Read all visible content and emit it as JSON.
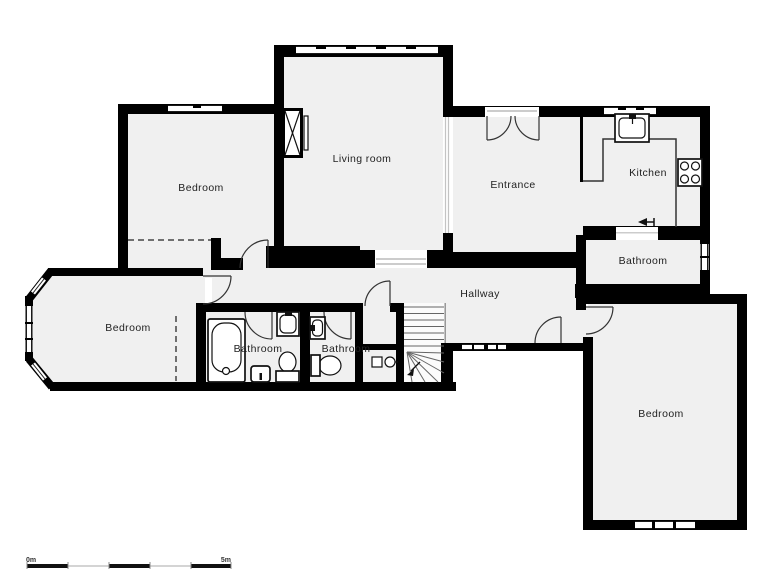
{
  "colors": {
    "wall": "#000000",
    "floor": "#f0f0f0",
    "background": "#ffffff",
    "door_arc": "#333333",
    "fixture_stroke": "#111111",
    "label_text": "#222222"
  },
  "rooms": [
    {
      "id": "bedroom-top-left",
      "label": "Bedroom"
    },
    {
      "id": "living-room",
      "label": "Living room"
    },
    {
      "id": "entrance",
      "label": "Entrance"
    },
    {
      "id": "kitchen",
      "label": "Kitchen"
    },
    {
      "id": "bathroom-top-right",
      "label": "Bathroom"
    },
    {
      "id": "hallway",
      "label": "Hallway"
    },
    {
      "id": "bedroom-left",
      "label": "Bedroom"
    },
    {
      "id": "bathroom-left",
      "label": "Bathroom"
    },
    {
      "id": "bathroom-middle",
      "label": "Bathroom"
    },
    {
      "id": "bedroom-bottom-right",
      "label": "Bedroom"
    }
  ],
  "fixtures": [
    "fireplace",
    "kitchen-sink",
    "stove",
    "counter",
    "bathtub",
    "sink",
    "toilet",
    "bidet-cabinet",
    "washer",
    "stairs",
    "entry-arrow"
  ],
  "scale_bar": {
    "start": "0m",
    "end": "5m"
  }
}
